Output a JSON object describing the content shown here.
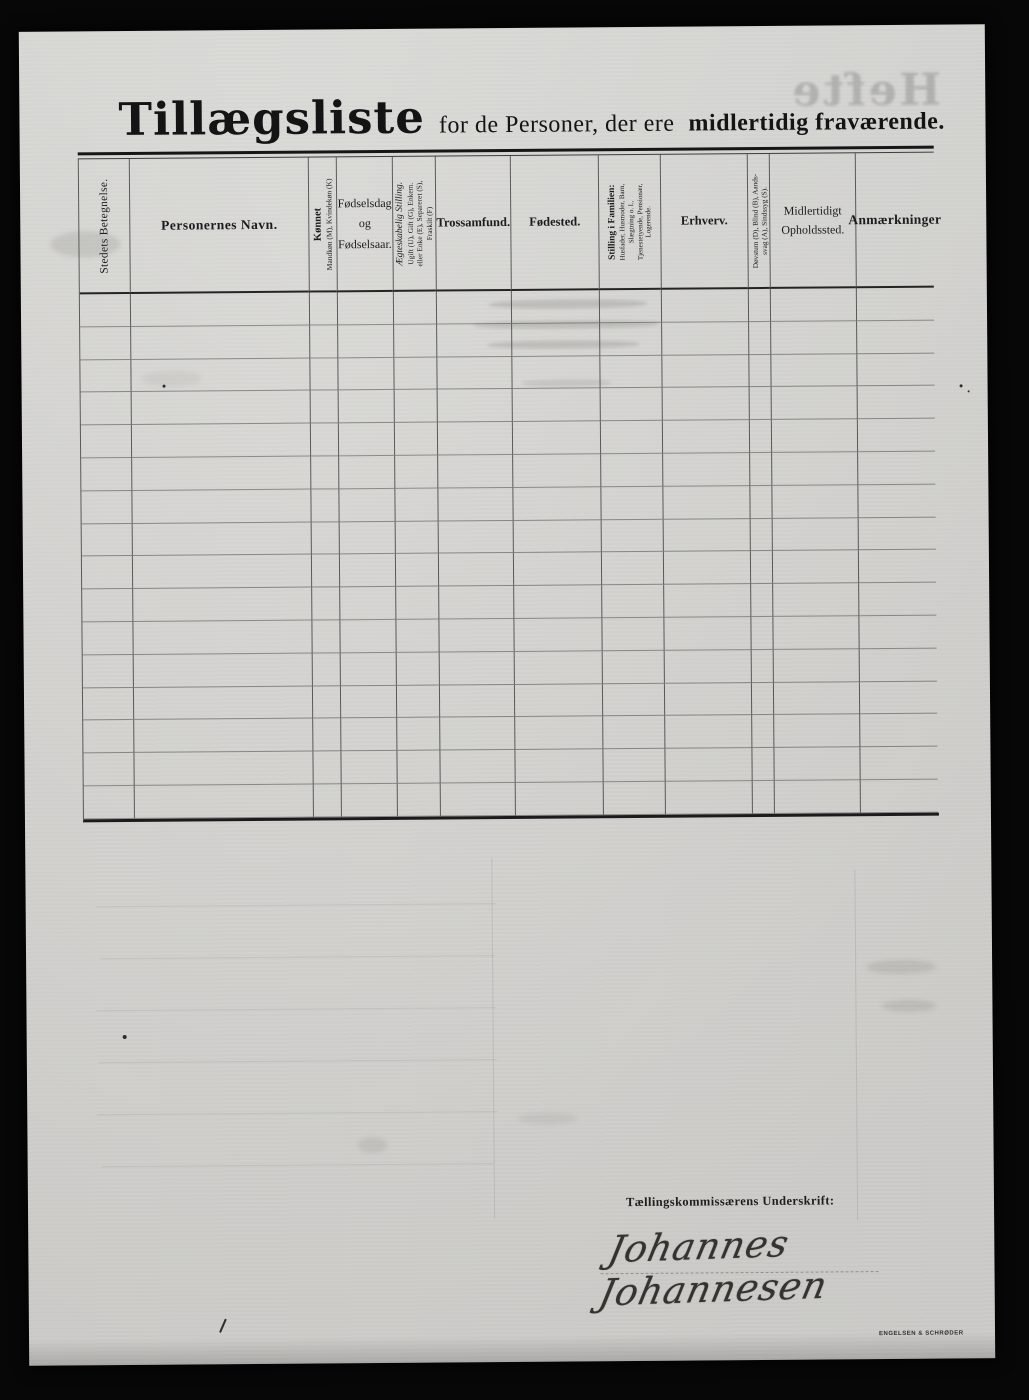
{
  "page": {
    "title_main": "Tillægsliste",
    "title_rest": "for de Personer, der ere",
    "title_bold": "midlertidig fraværende.",
    "ghost_text": "Hefte",
    "printer_mark": "ENGELSEN & SCHRØDER"
  },
  "table": {
    "row_count": 16,
    "columns": [
      {
        "id": "stedets-betegnelse",
        "label": "Stedets Betegnelse.",
        "orientation": "vertical"
      },
      {
        "id": "personernes-navn",
        "label": "Personernes Navn.",
        "orientation": "horizontal"
      },
      {
        "id": "konnet",
        "label": "Kønnet",
        "sub": "Mandkøn (M), Kvindekøn (K)",
        "orientation": "vertical"
      },
      {
        "id": "fodselsdag",
        "label": "Fødselsdag\nog\nFødselsaar.",
        "orientation": "horizontal"
      },
      {
        "id": "aegteskabelig-stilling",
        "label": "Ægteskabelig Stilling.",
        "sub": "Ugift (U), Gift (G), Enkem.\neller Enke (E), Separeret (S),\nFraskilt (F)",
        "orientation": "vertical"
      },
      {
        "id": "trossamfund",
        "label": "Trossamfund.",
        "orientation": "horizontal"
      },
      {
        "id": "fodested",
        "label": "Fødested.",
        "orientation": "horizontal"
      },
      {
        "id": "stilling-i-familien",
        "label": "Stilling i Familien:",
        "sub": "Husfader, Husmoder, Barn,\nSlægtning o. l.,\nTjenestetyende, Pensionær,\nLogerende.",
        "orientation": "vertical"
      },
      {
        "id": "erhverv",
        "label": "Erhverv.",
        "orientation": "horizontal"
      },
      {
        "id": "dovstum-blind",
        "label": "",
        "sub": "Døvstum (D), Blind (B), Aands-\nsvag (A), Sindssyg (S).",
        "orientation": "vertical"
      },
      {
        "id": "midlertidigt-opholdssted",
        "label": "Midlertidigt\nOpholdssted.",
        "orientation": "horizontal"
      },
      {
        "id": "anmaerkninger",
        "label": "Anmærkninger",
        "orientation": "horizontal"
      }
    ]
  },
  "footer": {
    "signature_label": "Tællingskommissærens Underskrift:",
    "signature_name": "Johannes Johannesen"
  },
  "colors": {
    "background": "#070707",
    "paper": "#d6d5d2",
    "ink": "#1c1c1c",
    "line_strong": "#242422",
    "line_faint": "#7a7a76"
  }
}
